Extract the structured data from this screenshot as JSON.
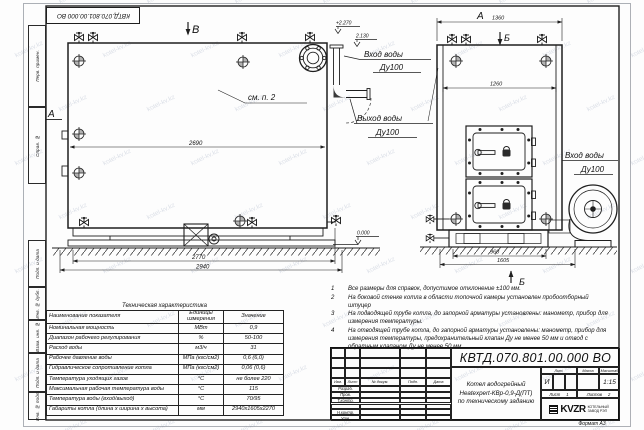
{
  "sheet": {
    "stamp_top": "КВТД.070.801.00.000  ВО",
    "format_note": "Формат  А3",
    "watermark": "kotel-kv.kz"
  },
  "frame": {
    "margin_boxes": [
      "Перв. примен.",
      "Справ. №",
      "Подп. и дата",
      "Инв. № дубл.",
      "Взам. инв. №",
      "Подп. и дата",
      "Инв. № подл."
    ]
  },
  "drawing": {
    "side_view": {
      "section_b": "В",
      "section_a": "А",
      "see_note": "см. п. 2",
      "dim_2690": "2690",
      "dim_2770": "2770",
      "dim_2940": "2940",
      "elev_top": "+2.270",
      "elev_pipe": "2.130",
      "elev_zero": "0.000"
    },
    "front_view": {
      "view_a": "А",
      "section_b_top": "Б",
      "section_b_bottom": "Б",
      "dim_1360": "1360",
      "dim_1260": "1260",
      "dim_960": "960",
      "dim_1605": "1605"
    },
    "pipe_labels": {
      "inlet_mid_1": "Вход воды",
      "inlet_mid_2": "Ду100",
      "outlet_1": "Выход воды",
      "outlet_2": "Ду100",
      "inlet_right_1": "Вход воды",
      "inlet_right_2": "Ду100"
    }
  },
  "notes": {
    "items": [
      "Все размеры для справок, допустимое отклонение  ±100 мм.",
      "На боковой стенке котла в области топочной камеры установлен пробоотборный штуцер",
      "На  подводящей трубе котла, до запорной арматуры установлены: манометр, прибор для измерения температуры.",
      "На отводящей трубе котла, до запорной арматуры установлены: манометр, прибор для измерения температуры, предохранительный клапан Ду не менее 50 мм и отвод с обратным клапаном Ду не менее 50 мм."
    ]
  },
  "spec_table": {
    "title": "Техническая характеристика",
    "headers": [
      "Наименование показателя",
      "Единицы измерения",
      "Значение"
    ],
    "rows": [
      [
        "Номинальная мощность",
        "МВт",
        "0,9"
      ],
      [
        "Диапазон рабочего регулирования",
        "%",
        "50-100"
      ],
      [
        "Расход воды",
        "м3/ч",
        "31"
      ],
      [
        "Рабочее давление воды",
        "МПа (кгс/см2)",
        "0,6 (6,0)"
      ],
      [
        "Гидравлическое сопротивление котла",
        "МПа (кгс/см2)",
        "0,06 (0,6)"
      ],
      [
        "Температура уходящих газов",
        "°С",
        "не более 220"
      ],
      [
        "Максимальная рабочая температура воды",
        "°С",
        "115"
      ],
      [
        "Температура воды (вход/выход)",
        "°С",
        "70/95"
      ],
      [
        "Габариты котла (длина х ширина х высота)",
        "мм",
        "2940х1605х2270"
      ]
    ]
  },
  "title_block": {
    "doc_number": "КВТД.070.801.00.000  ВО",
    "name_lines": [
      "Котел водогрейный",
      "Heatexpert-КВр-0,9-Д(ПТ)",
      "по техническому заданию"
    ],
    "header_row": [
      "Изм.",
      "Лист",
      "№ докум.",
      "Подп.",
      "Дата"
    ],
    "sig_rows": [
      "Разраб.",
      "Пров.",
      "Т.контр.",
      "",
      "Н.контр.",
      "Утв."
    ],
    "lit_header": "Лит.",
    "mass_header": "Масса",
    "scale_header": "Масштаб",
    "lit_value": "И",
    "scale_value": "1:15",
    "sheet_label": "Лист",
    "sheet_value": "1",
    "sheets_label": "Листов",
    "sheets_value": "2",
    "company_logo": "KVZR",
    "company_line1": "КОТЕЛЬНЫЙ",
    "company_line2": "ЗАВОД РЭП"
  }
}
